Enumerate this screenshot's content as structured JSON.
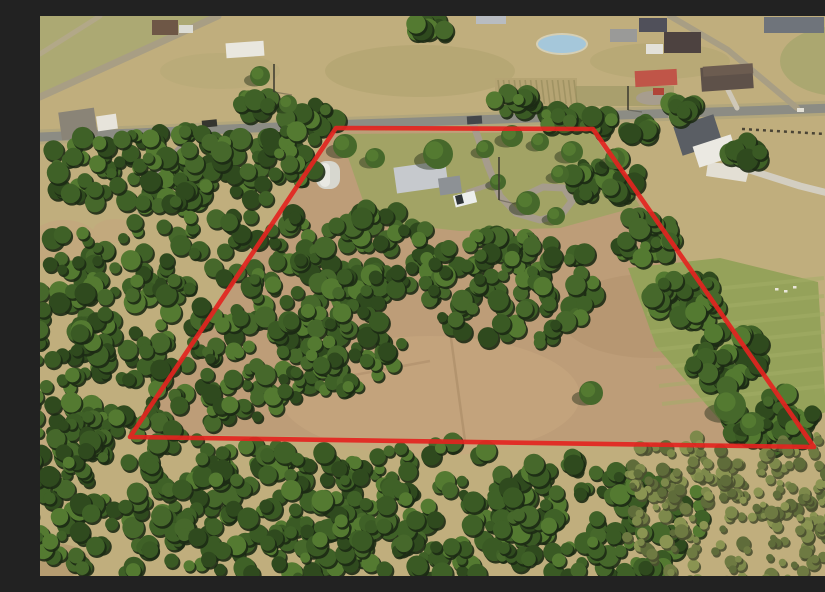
{
  "photo": {
    "width": 825,
    "height": 560,
    "base_color": "#c0ae7d",
    "boundary": {
      "color": "#e32420",
      "stroke_width": 4.6,
      "opacity": 0.92,
      "points": [
        [
          296,
          112
        ],
        [
          553,
          113
        ],
        [
          774,
          431
        ],
        [
          90,
          421
        ]
      ]
    },
    "palettes": {
      "forest": {
        "shadow": "#1c2a14",
        "fills": [
          "#2f4a1e",
          "#3a5a24",
          "#46682b",
          "#547a31",
          "#3f6127"
        ],
        "rmin": 5,
        "rmax": 11
      },
      "scrub": {
        "shadow": "#4a4f30",
        "fills": [
          "#6e7a42",
          "#7d894b",
          "#8a9452",
          "#5f6c3a"
        ],
        "rmin": 3,
        "rmax": 7
      }
    },
    "fields": {
      "interior": {
        "points": [
          [
            296,
            115
          ],
          [
            553,
            116
          ],
          [
            772,
            429
          ],
          [
            92,
            418
          ]
        ],
        "fill": "#bd9d78",
        "opacity": 1
      },
      "patches": [
        {
          "type": "polygon",
          "points": [
            [
              0,
              0
            ],
            [
              178,
              0
            ],
            [
              0,
              82
            ]
          ],
          "fill": "#aaa972",
          "opacity": 0.9
        },
        {
          "type": "ellipse",
          "cx": 380,
          "cy": 55,
          "rx": 95,
          "ry": 26,
          "fill": "#ab9f6c",
          "opacity": 0.5
        },
        {
          "type": "ellipse",
          "cx": 620,
          "cy": 45,
          "rx": 70,
          "ry": 18,
          "fill": "#b0a46f",
          "opacity": 0.5
        },
        {
          "type": "ellipse",
          "cx": 180,
          "cy": 55,
          "rx": 60,
          "ry": 18,
          "fill": "#b2a873",
          "opacity": 0.4
        },
        {
          "type": "ellipse",
          "cx": 800,
          "cy": 45,
          "rx": 60,
          "ry": 35,
          "fill": "#a3a46b",
          "opacity": 0.7
        },
        {
          "type": "ellipse",
          "cx": 24,
          "cy": 228,
          "rx": 36,
          "ry": 24,
          "fill": "#c2a87d",
          "opacity": 1
        },
        {
          "type": "ellipse",
          "cx": 18,
          "cy": 415,
          "rx": 26,
          "ry": 30,
          "fill": "#c2a87d",
          "opacity": 0.85
        },
        {
          "type": "ellipse",
          "cx": 10,
          "cy": 545,
          "rx": 40,
          "ry": 18,
          "fill": "#b49a70",
          "opacity": 0.9
        },
        {
          "type": "ellipse",
          "cx": 75,
          "cy": 215,
          "rx": 22,
          "ry": 12,
          "fill": "#c2a87d",
          "opacity": 0.9
        },
        {
          "type": "ellipse",
          "cx": 390,
          "cy": 380,
          "rx": 150,
          "ry": 60,
          "fill": "#c9a87f",
          "opacity": 0.55
        },
        {
          "type": "ellipse",
          "cx": 610,
          "cy": 300,
          "rx": 90,
          "ry": 42,
          "fill": "#ab8c67",
          "opacity": 0.35
        },
        {
          "type": "polygon",
          "points": [
            [
              300,
              118
            ],
            [
              552,
              116
            ],
            [
              600,
              190
            ],
            [
              520,
              212
            ],
            [
              420,
              215
            ],
            [
              330,
              205
            ]
          ],
          "fill": "#9da562",
          "opacity": 0.85
        },
        {
          "type": "polygon",
          "points": [
            [
              588,
              252
            ],
            [
              680,
              242
            ],
            [
              778,
              266
            ],
            [
              786,
              396
            ],
            [
              700,
              428
            ],
            [
              616,
              330
            ]
          ],
          "fill": "#95a25a",
          "opacity": 1
        },
        {
          "type": "polygon",
          "points": [
            [
              788,
              356
            ],
            [
              825,
              348
            ],
            [
              825,
              432
            ],
            [
              795,
              420
            ]
          ],
          "fill": "#8b9856",
          "opacity": 1
        }
      ],
      "crop_rows": {
        "x": 455,
        "y": 62,
        "w": 82,
        "h": 28,
        "n": 15,
        "base": "#b5a473",
        "line": "#9c8f60"
      },
      "dark_band": {
        "x": 536,
        "y": 70,
        "w": 98,
        "h": 20,
        "fill": "#8e8e5c",
        "opacity": 0.45
      },
      "tracks": [
        {
          "points": [
            [
              408,
              300
            ],
            [
              425,
              425
            ]
          ],
          "color": "#a98a66",
          "width": 2.5,
          "opacity": 0.6
        },
        {
          "points": [
            [
              298,
              362
            ],
            [
              390,
              345
            ]
          ],
          "color": "#a98a66",
          "width": 2.5,
          "opacity": 0.5
        }
      ],
      "lawn_stripes": {
        "count": 7,
        "x1": 604,
        "y1": 280,
        "x2": 784,
        "y2": 262,
        "dy": 18,
        "color": "#a3ae67",
        "width": 4,
        "opacity": 0.5
      },
      "lawn_specks": {
        "points": [
          [
            735,
            272
          ],
          [
            744,
            274
          ],
          [
            753,
            270
          ]
        ],
        "fill": "#e9e6da"
      }
    },
    "roads": [
      {
        "name": "main-road",
        "points": [
          [
            0,
            121
          ],
          [
            260,
            110
          ],
          [
            520,
            101
          ],
          [
            825,
            91
          ]
        ],
        "width": 9,
        "color": "#8c8c84",
        "casing": 15,
        "casing_color": "#b2a67c"
      },
      {
        "name": "side-road-topleft",
        "points": [
          [
            0,
            81
          ],
          [
            178,
            0
          ]
        ],
        "width": 7,
        "color": "#a89e84",
        "casing": 0,
        "casing_color": ""
      },
      {
        "name": "corner-road-topleft",
        "points": [
          [
            0,
            38
          ],
          [
            60,
            0
          ]
        ],
        "width": 5,
        "color": "#b2a888",
        "casing": 0,
        "casing_color": ""
      },
      {
        "name": "side-road-topright",
        "points": [
          [
            630,
            0
          ],
          [
            688,
            34
          ],
          [
            757,
            92
          ]
        ],
        "width": 6,
        "color": "#a89e84",
        "casing": 0,
        "casing_color": ""
      },
      {
        "name": "gravel-lane-left",
        "points": [
          [
            160,
            113
          ],
          [
            120,
            150
          ],
          [
            100,
            195
          ]
        ],
        "width": 5,
        "color": "#9e9588",
        "casing": 0,
        "casing_color": ""
      }
    ],
    "driveways": [
      {
        "name": "parcel-driveway-loop",
        "points": [
          [
            432,
            104
          ],
          [
            448,
            150
          ],
          [
            460,
            180
          ],
          [
            476,
            197
          ],
          [
            500,
            204
          ],
          [
            522,
            198
          ],
          [
            532,
            185
          ],
          [
            524,
            172
          ],
          [
            503,
            171
          ],
          [
            482,
            181
          ]
        ],
        "width": 7,
        "color": "#a69c8d"
      },
      {
        "name": "parcel-driveway-spur",
        "points": [
          [
            452,
            168
          ],
          [
            428,
            176
          ]
        ],
        "width": 5,
        "color": "#a69c8d"
      },
      {
        "name": "neighbor-long-driveway",
        "points": [
          [
            697,
            150
          ],
          [
            760,
            170
          ],
          [
            800,
            180
          ],
          [
            825,
            186
          ]
        ],
        "width": 7,
        "color": "#d3cec1"
      },
      {
        "name": "barn-lane",
        "points": [
          [
            622,
            80
          ],
          [
            632,
            103
          ]
        ],
        "width": 5,
        "color": "#b3a996"
      },
      {
        "name": "house13-lane",
        "points": [
          [
            688,
            74
          ],
          [
            697,
            92
          ]
        ],
        "width": 5,
        "color": "#cfc8b8"
      }
    ],
    "pads": [
      {
        "type": "polygon",
        "points": [
          [
            668,
            146
          ],
          [
            710,
            150
          ],
          [
            706,
            166
          ],
          [
            666,
            160
          ]
        ],
        "fill": "#e3dfd4"
      },
      {
        "type": "ellipse",
        "cx": 613,
        "cy": 82,
        "rx": 17,
        "ry": 7,
        "fill": "#a79d8e"
      }
    ],
    "pond": {
      "cx": 522,
      "cy": 28,
      "rx": 24,
      "ry": 9,
      "fill": "#a5c7da",
      "rim": "#d6cfb4"
    },
    "fence": {
      "x1": 702,
      "y1": 113,
      "x2": 802,
      "y2": 119,
      "color": "#4a4435",
      "width": 2.5,
      "dash": "3 4"
    },
    "buildings": [
      {
        "name": "house-nw",
        "x": 20,
        "y": 94,
        "w": 36,
        "h": 28,
        "rot": -8,
        "fill": "#8a8477"
      },
      {
        "name": "shed-nw",
        "x": 57,
        "y": 99,
        "w": 20,
        "h": 15,
        "rot": -8,
        "fill": "#e7e4db"
      },
      {
        "name": "building-top-left",
        "x": 112,
        "y": 4,
        "w": 26,
        "h": 15,
        "rot": 0,
        "fill": "#6e5746"
      },
      {
        "name": "trailer-top-left",
        "x": 139,
        "y": 9,
        "w": 14,
        "h": 8,
        "rot": 0,
        "fill": "#dcdcd4"
      },
      {
        "name": "white-barn-top",
        "x": 186,
        "y": 26,
        "w": 38,
        "h": 15,
        "rot": -4,
        "fill": "#e9e7df"
      },
      {
        "name": "building-top-center",
        "x": 436,
        "y": 0,
        "w": 30,
        "h": 8,
        "rot": 0,
        "fill": "#b8bcc1"
      },
      {
        "name": "gray-house-top",
        "x": 570,
        "y": 13,
        "w": 27,
        "h": 13,
        "rot": 0,
        "fill": "#9a9a98"
      },
      {
        "name": "dark-roof-house-top",
        "x": 599,
        "y": 2,
        "w": 28,
        "h": 14,
        "rot": 0,
        "fill": "#50505a"
      },
      {
        "name": "large-dark-house",
        "x": 624,
        "y": 16,
        "w": 37,
        "h": 21,
        "rot": 0,
        "fill": "#4d4240"
      },
      {
        "name": "white-shed-top",
        "x": 606,
        "y": 28,
        "w": 17,
        "h": 10,
        "rot": 0,
        "fill": "#e3e1d9"
      },
      {
        "name": "warehouse-topright",
        "x": 724,
        "y": 1,
        "w": 60,
        "h": 16,
        "rot": 0,
        "fill": "#6f747b"
      },
      {
        "name": "red-roof-barn",
        "x": 595,
        "y": 54,
        "w": 42,
        "h": 16,
        "rot": -3,
        "fill": "#c05548"
      },
      {
        "name": "brown-roof-house",
        "x": 661,
        "y": 50,
        "w": 52,
        "h": 24,
        "rot": -4,
        "fill": "#5e5149"
      },
      {
        "name": "brown-roof-house-ridge",
        "x": 663,
        "y": 49,
        "w": 50,
        "h": 10,
        "rot": -4,
        "fill": "#6c5c50"
      },
      {
        "name": "white-house-roof",
        "x": 637,
        "y": 104,
        "w": 42,
        "h": 30,
        "rot": -18,
        "fill": "#5a5e64"
      },
      {
        "name": "white-house-wall",
        "x": 655,
        "y": 124,
        "w": 40,
        "h": 22,
        "rot": -18,
        "fill": "#ebe9e2"
      },
      {
        "name": "right-edge-house-roof",
        "x": 785,
        "y": 295,
        "w": 40,
        "h": 32,
        "rot": 0,
        "fill": "#6a5544"
      },
      {
        "name": "right-edge-house-wall",
        "x": 789,
        "y": 323,
        "w": 36,
        "h": 32,
        "rot": 0,
        "fill": "#e9e3d7"
      },
      {
        "name": "parcel-house-roof",
        "x": 355,
        "y": 148,
        "w": 52,
        "h": 26,
        "rot": -8,
        "fill": "#c6c9cd"
      },
      {
        "name": "parcel-house-wing",
        "x": 399,
        "y": 161,
        "w": 22,
        "h": 17,
        "rot": -8,
        "fill": "#8d9195"
      },
      {
        "name": "parcel-quonset-barn",
        "x": 276,
        "y": 145,
        "w": 24,
        "h": 28,
        "rot": 0,
        "fill": "#d7d7cf",
        "rx": 10
      },
      {
        "name": "parcel-quonset-highlight",
        "x": 280,
        "y": 147,
        "w": 10,
        "h": 24,
        "rot": 0,
        "fill": "#e9e9e3",
        "rx": 5
      }
    ],
    "vehicles": [
      {
        "name": "white-truck",
        "x": 414,
        "y": 177,
        "w": 22,
        "h": 12,
        "rot": -14,
        "fill": "#eceeec"
      },
      {
        "name": "white-truck-cab",
        "x": 416,
        "y": 179,
        "w": 7,
        "h": 9,
        "rot": -14,
        "fill": "#2e3336"
      },
      {
        "name": "car-on-road-left",
        "x": 162,
        "y": 104,
        "w": 15,
        "h": 7,
        "rot": -6,
        "fill": "#35352f"
      },
      {
        "name": "car-at-entrance",
        "x": 427,
        "y": 100,
        "w": 15,
        "h": 8,
        "rot": -4,
        "fill": "#43464a"
      },
      {
        "name": "tractor-at-barn",
        "x": 613,
        "y": 72,
        "w": 11,
        "h": 7,
        "rot": 0,
        "fill": "#b04438"
      },
      {
        "name": "car-on-road-right",
        "x": 757,
        "y": 92,
        "w": 7,
        "h": 4,
        "rot": 0,
        "fill": "#e4e1d6"
      }
    ],
    "tree_clusters": [
      [
        115,
        152,
        120,
        42,
        110,
        "f"
      ],
      [
        170,
        290,
        140,
        118,
        240,
        "f"
      ],
      [
        28,
        350,
        46,
        150,
        90,
        "f"
      ],
      [
        330,
        240,
        72,
        48,
        85,
        "f"
      ],
      [
        472,
        272,
        92,
        58,
        110,
        "f"
      ],
      [
        300,
        332,
        62,
        44,
        65,
        "f"
      ],
      [
        565,
        162,
        36,
        26,
        35,
        "f"
      ],
      [
        610,
        222,
        34,
        26,
        35,
        "f"
      ],
      [
        648,
        282,
        36,
        26,
        38,
        "f"
      ],
      [
        688,
        342,
        40,
        30,
        42,
        "f"
      ],
      [
        728,
        402,
        46,
        34,
        48,
        "f"
      ],
      [
        82,
        478,
        112,
        82,
        150,
        "f"
      ],
      [
        235,
        500,
        120,
        75,
        140,
        "f"
      ],
      [
        400,
        492,
        120,
        72,
        140,
        "f"
      ],
      [
        556,
        500,
        108,
        66,
        120,
        "f"
      ],
      [
        700,
        508,
        118,
        62,
        120,
        "s"
      ],
      [
        775,
        468,
        62,
        52,
        70,
        "s"
      ],
      [
        640,
        455,
        60,
        40,
        55,
        "s"
      ],
      [
        270,
        100,
        30,
        12,
        16,
        "f"
      ],
      [
        215,
        88,
        20,
        10,
        10,
        "f"
      ],
      [
        520,
        102,
        22,
        10,
        12,
        "f"
      ],
      [
        560,
        108,
        18,
        9,
        10,
        "f"
      ],
      [
        598,
        112,
        18,
        8,
        10,
        "f"
      ],
      [
        470,
        86,
        26,
        10,
        12,
        "f"
      ],
      [
        390,
        12,
        18,
        10,
        10,
        "f"
      ],
      [
        640,
        92,
        16,
        8,
        8,
        "f"
      ],
      [
        708,
        137,
        18,
        12,
        12,
        "f"
      ],
      [
        250,
        140,
        30,
        28,
        30,
        "f"
      ]
    ],
    "trees": [
      [
        398,
        138,
        15
      ],
      [
        305,
        130,
        12
      ],
      [
        335,
        142,
        10
      ],
      [
        445,
        133,
        9
      ],
      [
        472,
        120,
        11
      ],
      [
        500,
        126,
        9
      ],
      [
        532,
        136,
        11
      ],
      [
        458,
        166,
        8
      ],
      [
        520,
        158,
        9
      ],
      [
        488,
        187,
        12
      ],
      [
        516,
        200,
        9
      ],
      [
        551,
        377,
        12
      ],
      [
        575,
        143,
        10
      ],
      [
        220,
        60,
        10
      ],
      [
        248,
        88,
        9
      ],
      [
        690,
        390,
        16
      ],
      [
        712,
        408,
        12
      ]
    ],
    "poles": [
      {
        "line": [
          459,
          141,
          459,
          184
        ],
        "shadow": [
          459,
          184,
          476,
          188
        ]
      },
      {
        "line": [
          234,
          48,
          234,
          76
        ],
        "shadow": [
          234,
          76,
          252,
          79
        ]
      },
      {
        "line": [
          588,
          70,
          588,
          94
        ],
        "shadow": [
          588,
          94,
          602,
          96
        ]
      }
    ]
  }
}
